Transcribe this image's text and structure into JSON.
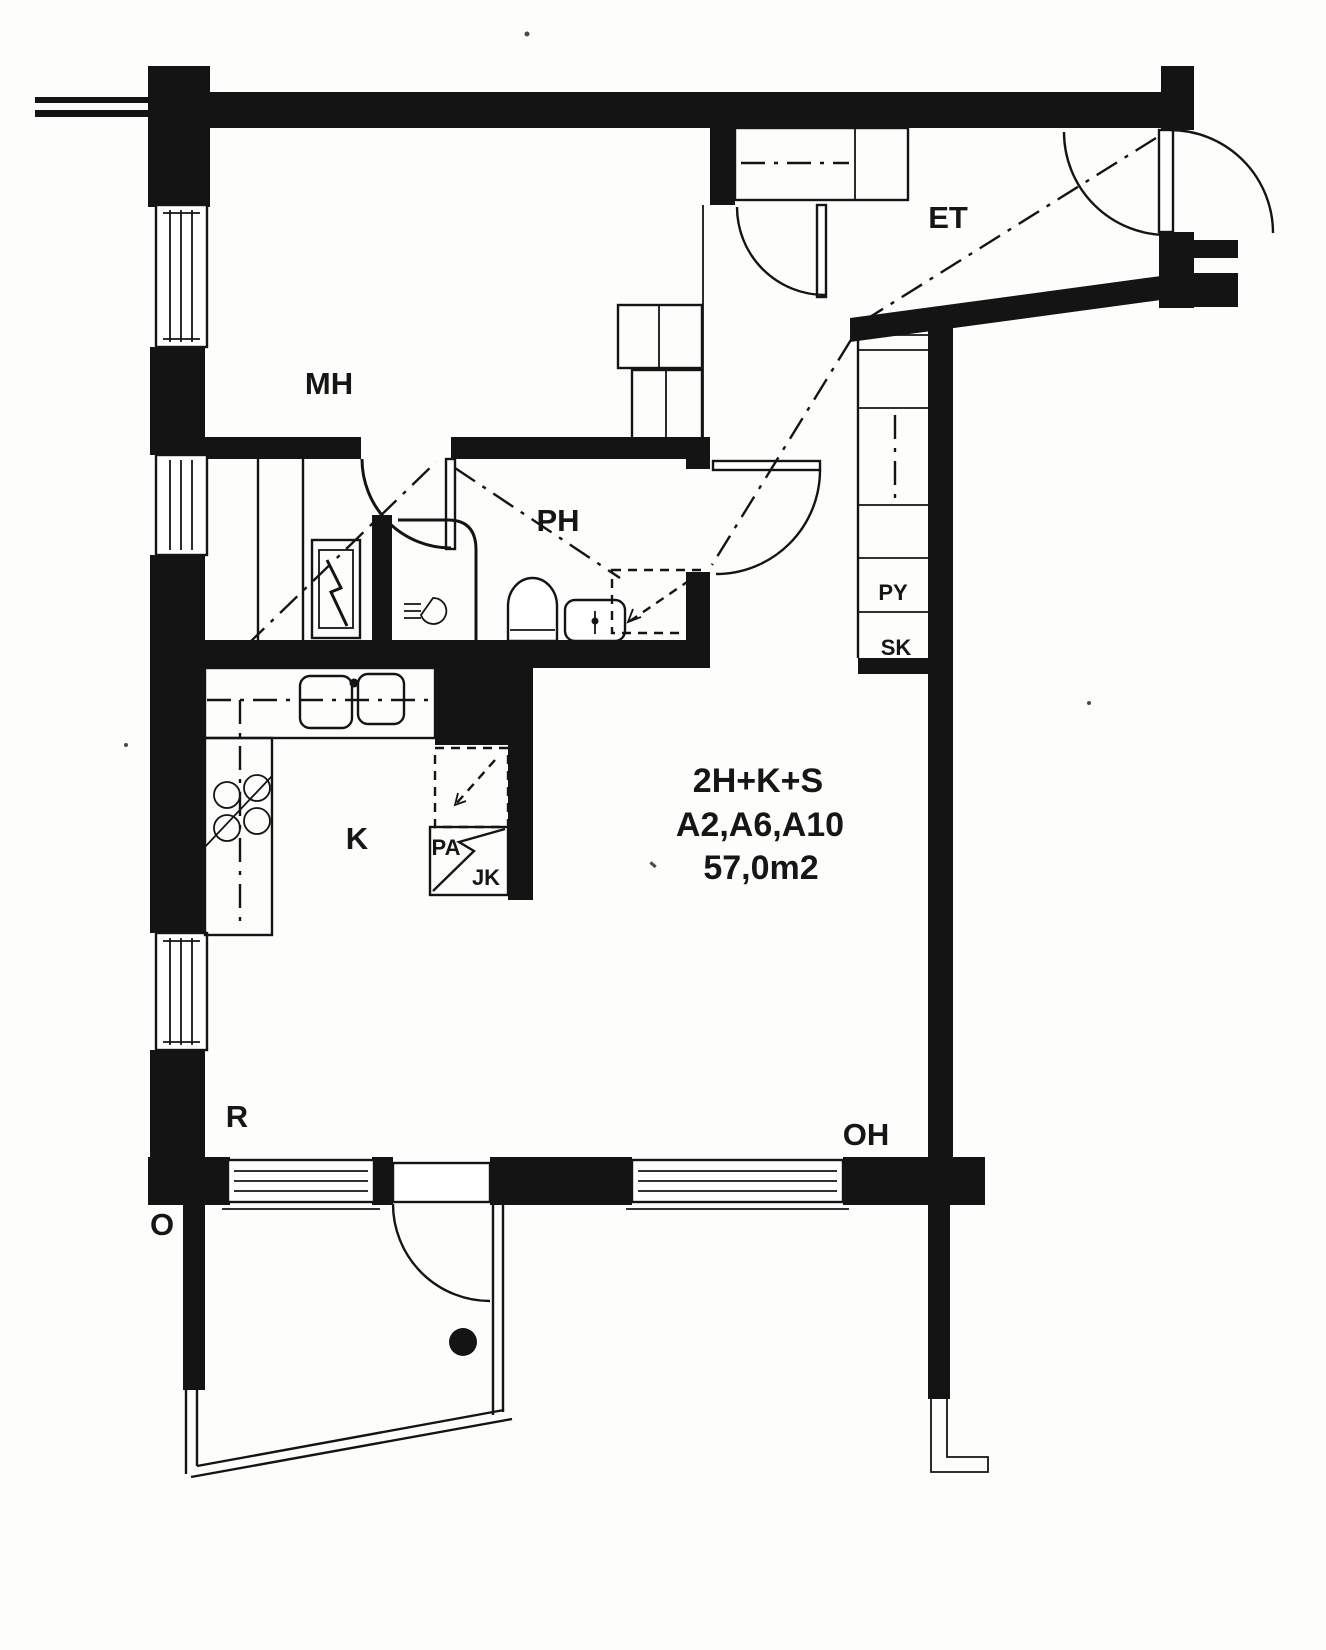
{
  "plan": {
    "rooms": {
      "mh": "MH",
      "ph": "PH",
      "et": "ET",
      "k": "K",
      "oh": "OH",
      "r": "R"
    },
    "closets": {
      "py": "PY",
      "sk": "SK"
    },
    "appliances": {
      "pa": "PA",
      "jk": "JK"
    },
    "outside_label": "O",
    "apartment": {
      "type": "2H+K+S",
      "units": "A2,A6,A10",
      "area": "57,0m2"
    },
    "colors": {
      "ink": "#141414",
      "paper": "#fdfdfc"
    }
  }
}
